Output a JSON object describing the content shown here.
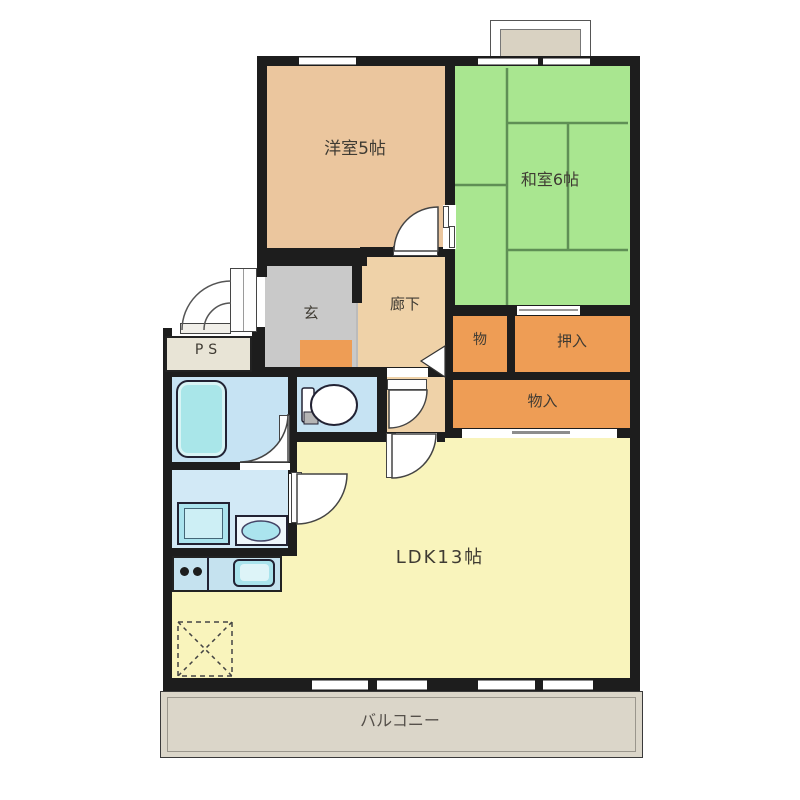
{
  "plan": {
    "rooms": {
      "western_room": {
        "label": "洋室5帖"
      },
      "japanese_room": {
        "label": "和室6帖"
      },
      "entrance": {
        "label": "玄"
      },
      "hallway": {
        "label": "廊下"
      },
      "pipe_space": {
        "label": "PS"
      },
      "storage_small": {
        "label": "物"
      },
      "closet": {
        "label": "押入"
      },
      "storage_large": {
        "label": "物入"
      },
      "ldk": {
        "label": "LDK13帖"
      },
      "balcony": {
        "label": "バルコニー"
      }
    },
    "fixtures": [
      "bathtub",
      "toilet",
      "washbasin",
      "washing-machine",
      "kitchen-counter",
      "stove-burners",
      "kitchen-sink",
      "floor-storage-hatch",
      "bay-window",
      "entrance-door",
      "sliding-doors",
      "hinged-doors",
      "tatami-mats"
    ],
    "colors": {
      "wall": "#1d1d1d",
      "western_room": "#ebc69e",
      "japanese_room": "#a9e690",
      "hallway": "#efd2a8",
      "entrance_gray": "#c9c9c9",
      "closet_orange": "#ee9d55",
      "ldk_yellow": "#f9f4bc",
      "wet_area_blue": "#c6e3f3",
      "washroom_blue": "#d2e9f6",
      "fixture_cyan": "#a9e6e9",
      "balcony_gray": "#dbd6c9"
    }
  }
}
